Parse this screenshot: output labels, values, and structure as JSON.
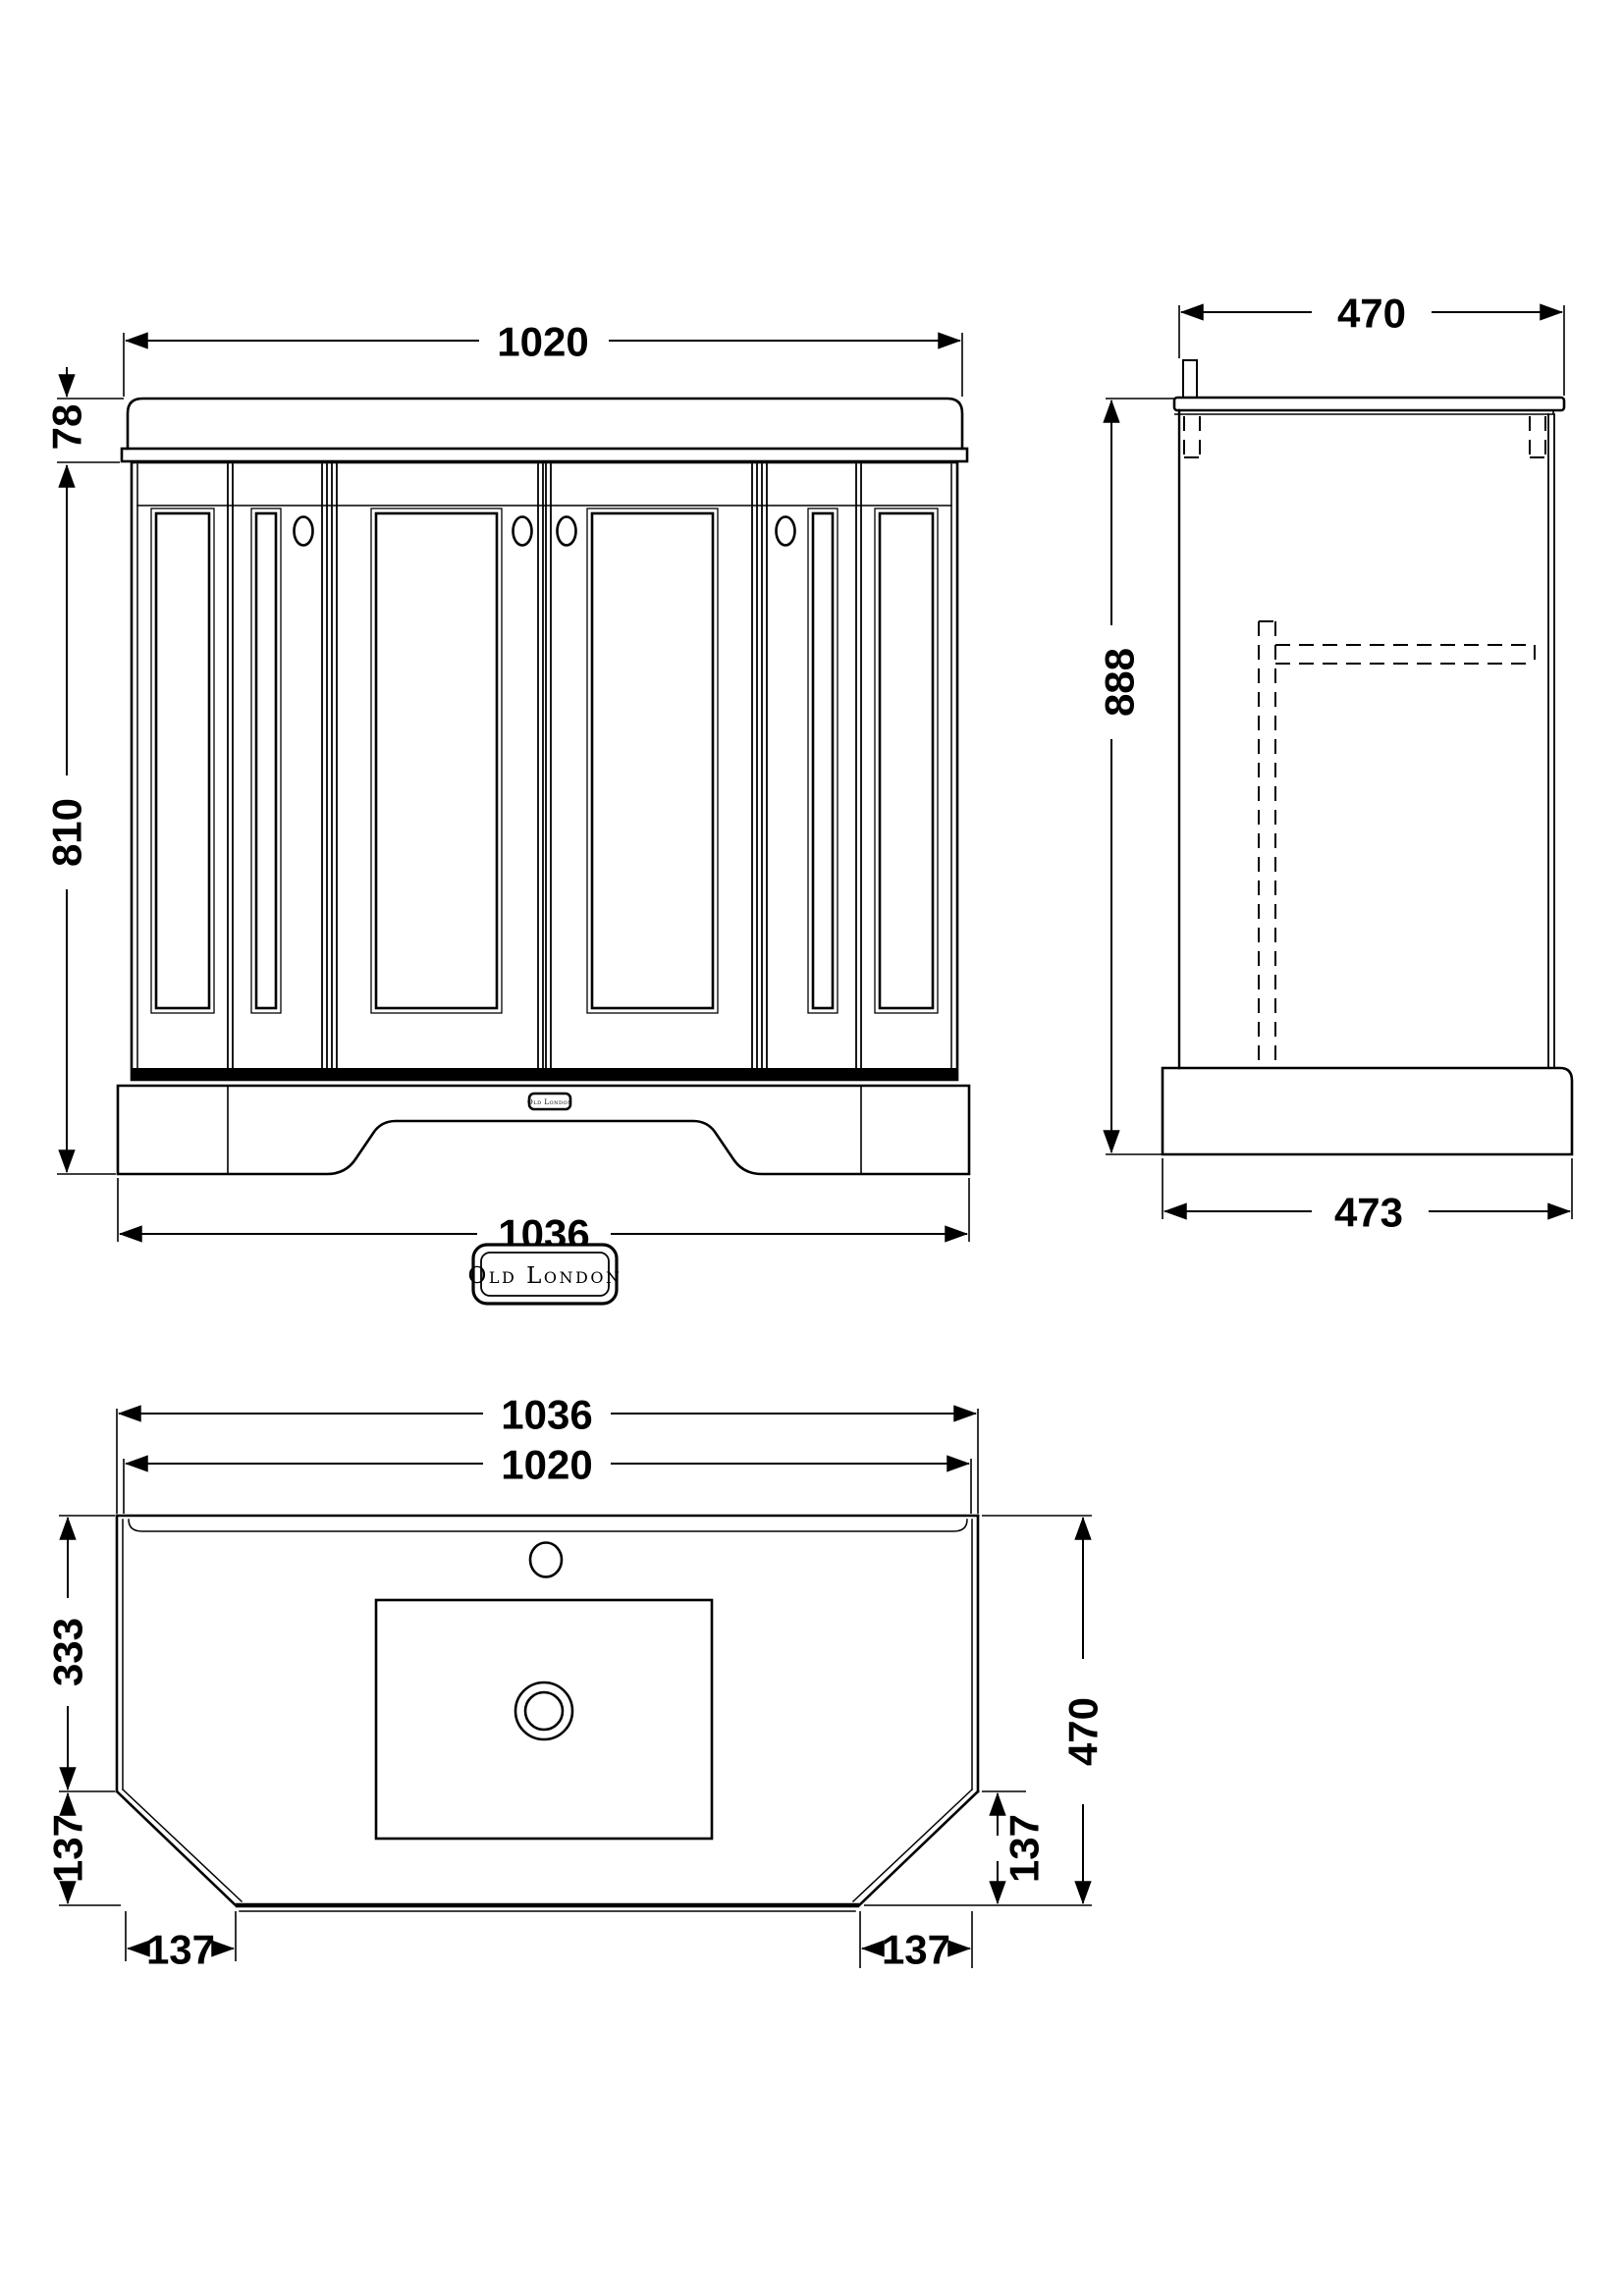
{
  "brand": {
    "badge_label": "Old London",
    "plinth_label": "Old London"
  },
  "front_view": {
    "dim_top_width": "1020",
    "dim_counter_height": "78",
    "dim_cabinet_height": "810",
    "dim_base_width": "1036"
  },
  "side_view": {
    "dim_top_depth": "470",
    "dim_total_height": "888",
    "dim_base_depth": "473"
  },
  "plan_view": {
    "dim_outer_width": "1036",
    "dim_inner_width": "1020",
    "dim_back_depth": "333",
    "dim_left_edge": "137",
    "dim_left_front": "137",
    "dim_total_depth": "470",
    "dim_right_edge": "137",
    "dim_right_front": "137"
  }
}
